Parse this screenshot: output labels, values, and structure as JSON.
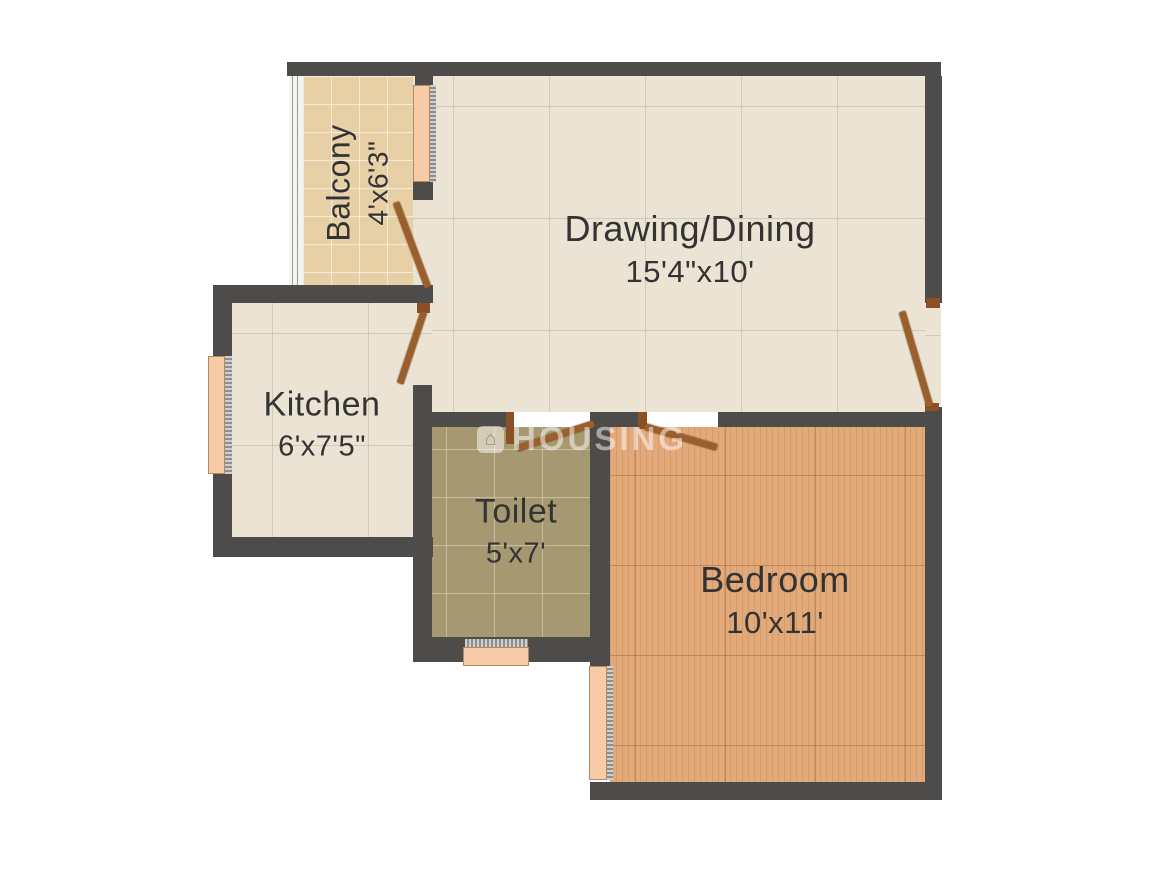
{
  "watermark": {
    "text": "HOUSING",
    "logo_icon": "house-icon"
  },
  "rooms": [
    {
      "id": "balcony",
      "name": "Balcony",
      "dims": "4'x6'3\""
    },
    {
      "id": "drawing",
      "name": "Drawing/Dining",
      "dims": "15'4\"x10'"
    },
    {
      "id": "kitchen",
      "name": "Kitchen",
      "dims": "6'x7'5\""
    },
    {
      "id": "toilet",
      "name": "Toilet",
      "dims": "5'x7'"
    },
    {
      "id": "bedroom",
      "name": "Bedroom",
      "dims": "10'x11'"
    }
  ],
  "colors": {
    "background": "#ffffff",
    "wall": "#4e4c4a",
    "floor_cream": "#ebe3d4",
    "floor_balcony": "#e8d0a6",
    "floor_toilet": "#a69972",
    "floor_bedroom": "#e2a97a",
    "window": "#f6cba6",
    "door": "#9b5e2d",
    "label_text": "#333333"
  }
}
